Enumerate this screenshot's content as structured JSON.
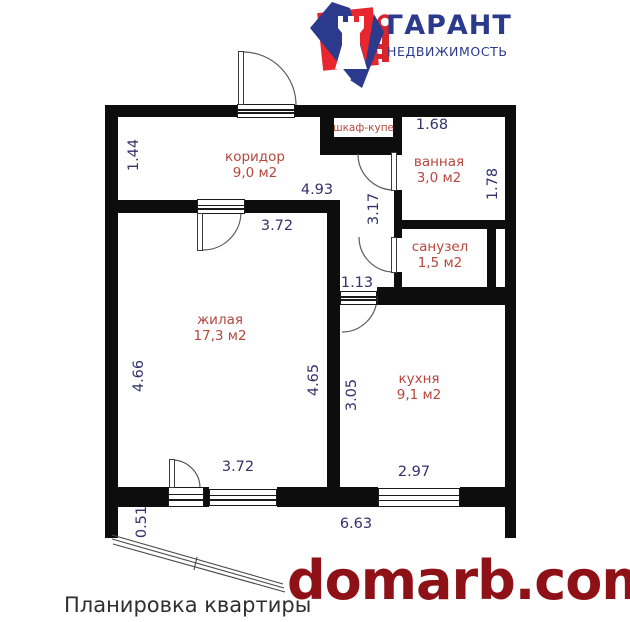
{
  "logo": {
    "title": "ГАРАНТ",
    "subtitle": "НЕДВИЖИМОСТЬ",
    "brand_blue": "#2c3a8d",
    "brand_red": "#e8262d"
  },
  "caption": "Планировка квартиры",
  "watermark": {
    "text": "domarb.com",
    "color": "#8e1117"
  },
  "rooms": {
    "corridor": {
      "name": "коридор",
      "area": "9,0 м2"
    },
    "bathroom": {
      "name": "ванная",
      "area": "3,0 м2"
    },
    "wc": {
      "name": "санузел",
      "area": "1,5 м2"
    },
    "living": {
      "name": "жилая",
      "area": "17,3 м2"
    },
    "kitchen": {
      "name": "кухня",
      "area": "9,1 м2"
    },
    "wardrobe": {
      "name": "шкаф-купе"
    }
  },
  "dimensions": {
    "corridor_left": "1.44",
    "corridor_width": "4.93",
    "bathroom_top": "1.68",
    "bathroom_right": "1.78",
    "hallway_height": "3.17",
    "hallway_door": "1.13",
    "living_top": "3.72",
    "living_left": "4.66",
    "living_right": "4.65",
    "living_bottom": "3.72",
    "kitchen_left": "3.05",
    "kitchen_bottom": "2.97",
    "bottom_total": "6.63",
    "balcony_side": "0.51"
  },
  "colors": {
    "room_label": "#b5473c",
    "dimension": "#32316b",
    "wall": "#0d0d0d"
  }
}
